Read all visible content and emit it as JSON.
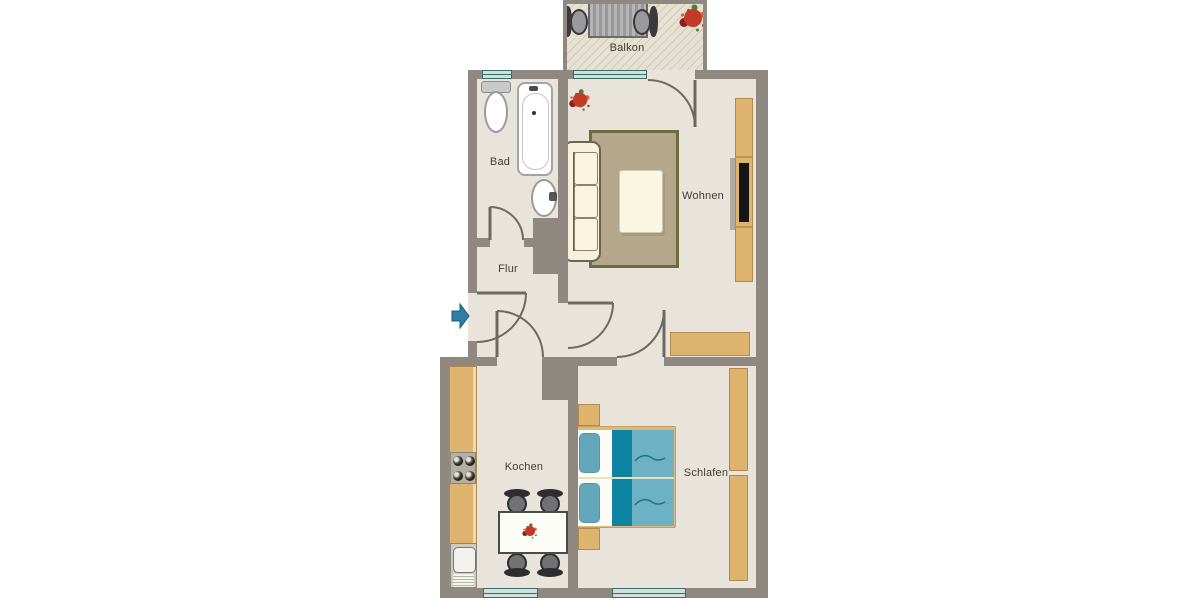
{
  "plan": {
    "type": "apartment-floor-plan"
  },
  "rooms": {
    "balkon": {
      "label": "Balkon",
      "furniture": [
        "patio-table",
        "patio-chair-left",
        "patio-chair-right",
        "flower-pot"
      ]
    },
    "bad": {
      "label": "Bad",
      "furniture": [
        "toilet",
        "bathtub",
        "washbasin"
      ]
    },
    "flur": {
      "label": "Flur",
      "furniture": []
    },
    "wohnen": {
      "label": "Wohnen",
      "furniture": [
        "sofa",
        "rug",
        "coffee-table",
        "tv-sideboard",
        "tv",
        "lowboard",
        "plant"
      ]
    },
    "kochen": {
      "label": "Kochen",
      "furniture": [
        "kitchen-counter",
        "stove",
        "kitchen-sink",
        "dining-table",
        "four-chairs",
        "table-flowers"
      ]
    },
    "schlafen": {
      "label": "Schlafen",
      "furniture": [
        "double-bed",
        "nightstand-top",
        "nightstand-bottom",
        "wardrobe-upper",
        "wardrobe-lower"
      ]
    }
  },
  "entrance": {
    "icon": "entrance-arrow-right-icon"
  },
  "colors": {
    "wall": "#8e8880",
    "floor": "#e8e4db",
    "balcony-floor": "#e7e1d4",
    "balcony-hatch": "#d2cbbb",
    "tan": "#ddb36e",
    "tan-border": "#b08a4e",
    "rug": "#b4a78b",
    "rug-border": "#6c6c3c",
    "cream": "#f7f1da",
    "cream-border": "#6b6353",
    "window-fill": "#cfe1dd",
    "window-frame": "#3f6b66",
    "bed-light": "#6db1c5",
    "bed-dark": "#0c84a2",
    "pillow": "#63a7bb",
    "door-line": "#6e6960",
    "arrow": "#2e7ea6",
    "label": "#3f3d39"
  }
}
